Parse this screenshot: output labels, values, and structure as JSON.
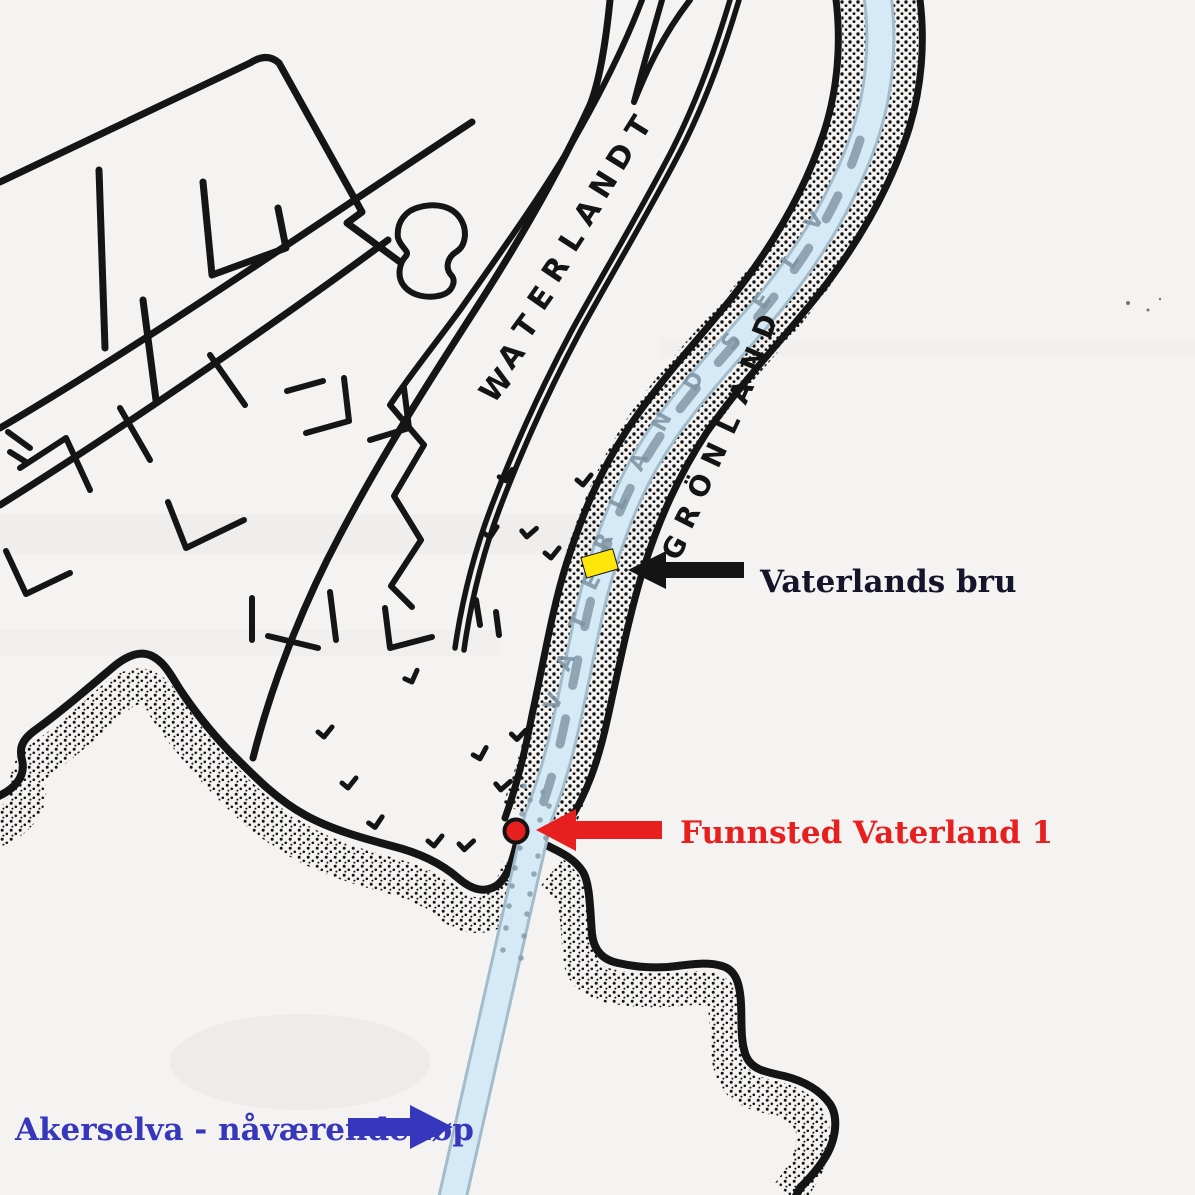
{
  "map": {
    "road_label": {
      "text": "WATERLANDT"
    },
    "district_label": {
      "text": "GRÖNLAND"
    },
    "river_old": {
      "inline_letters": [
        "V",
        "A",
        "T",
        "E",
        "R",
        "L",
        "A",
        "N",
        "D",
        "S",
        "E",
        "L",
        "V"
      ]
    }
  },
  "annotations": {
    "bridge": {
      "label": "Vaterlands bru",
      "text_color": "#14142a",
      "arrow_color": "#141414",
      "marker_color": "#ffe60a"
    },
    "site": {
      "label": "Funnsted Vaterland 1",
      "color": "#e81f1f",
      "dot_fill": "#e81f1f",
      "dot_outline": "#141414"
    },
    "river": {
      "label": "Akerselva - nåværende løp",
      "color": "#3637bd"
    }
  },
  "colors": {
    "paper": "#f5f3f1",
    "ink": "#151515",
    "river_fill": "#d6e9f6",
    "river_edge": "#a3bccb",
    "slate_shading": "#8299a8"
  }
}
